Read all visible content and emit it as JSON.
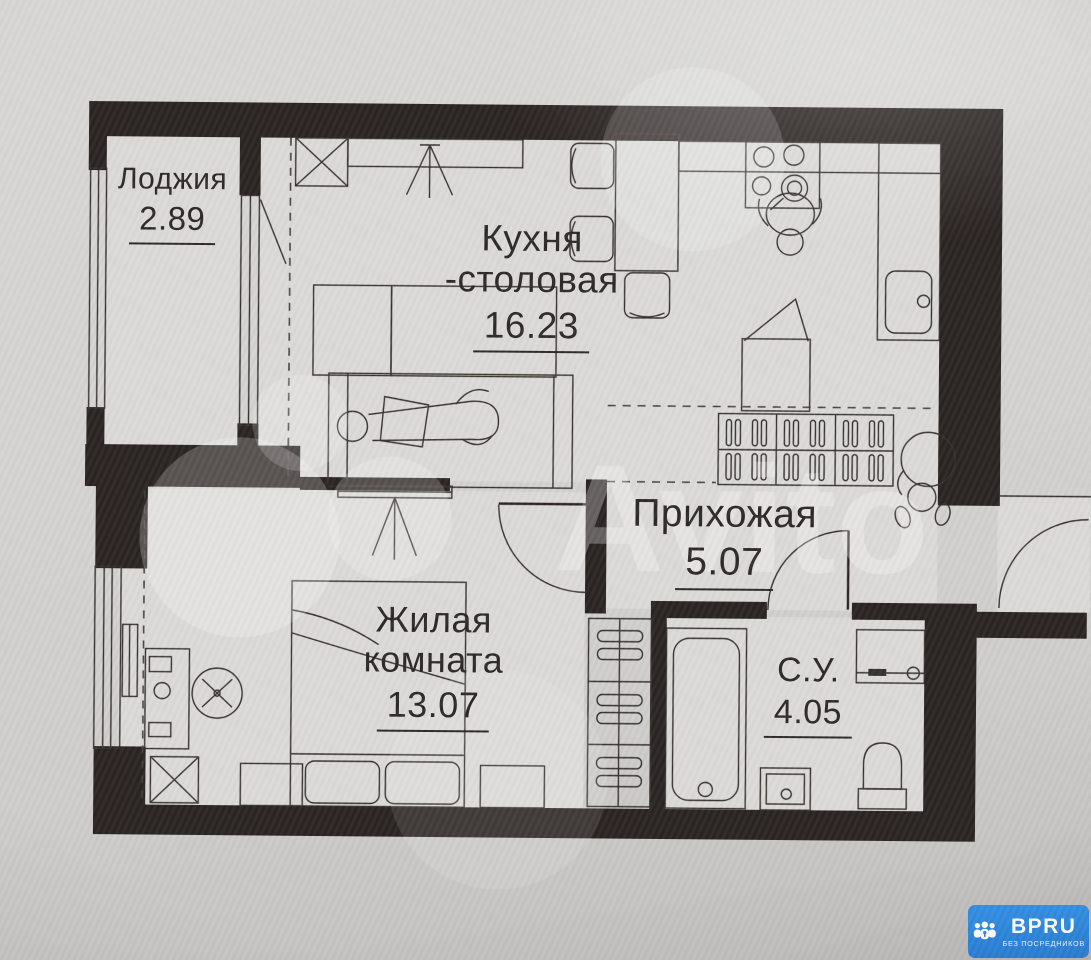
{
  "rooms": {
    "loggia": {
      "name": "Лоджия",
      "area": "2.89"
    },
    "kitchen": {
      "name_line1": "Кухня",
      "name_line2": "-столовая",
      "area": "16.23"
    },
    "hallway": {
      "name": "Прихожая",
      "area": "5.07"
    },
    "living": {
      "name_line1": "Жилая",
      "name_line2": "комната",
      "area": "13.07"
    },
    "bathroom": {
      "name": "С.У.",
      "area": "4.05"
    }
  },
  "watermark": {
    "text": "Avito"
  },
  "branding": {
    "logo_text": "BPRU",
    "tagline": "БЕЗ ПОСРЕДНИКОВ",
    "color": "#2f88dd"
  }
}
